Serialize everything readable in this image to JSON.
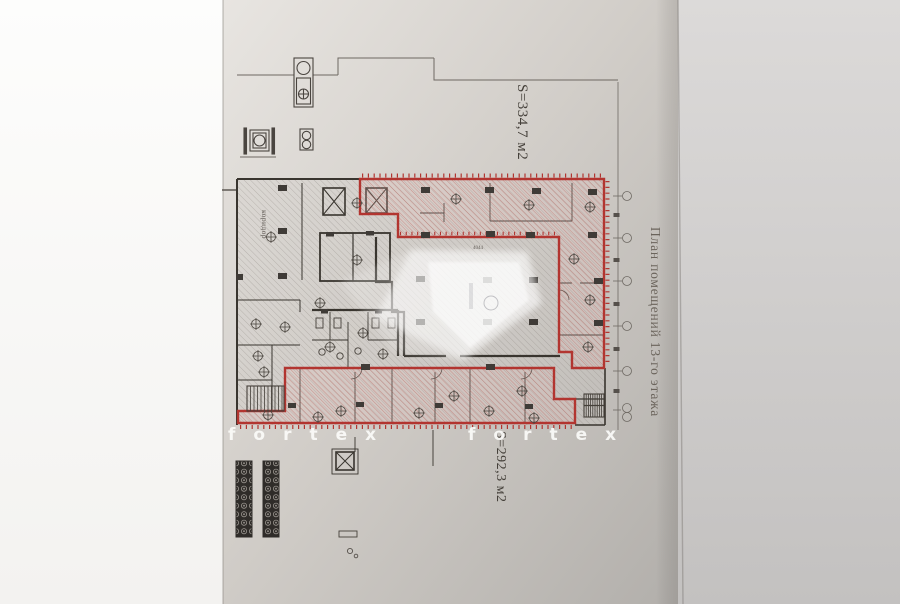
{
  "plan": {
    "title": "План помещений 13-го этажа",
    "area_top": "S=334,7 м2",
    "area_bottom": "S=292,3 м2",
    "left_room_label": "коридор",
    "dim_top": "4044"
  },
  "watermark": {
    "text": "fortex"
  },
  "colors": {
    "zone_red": "#b23530",
    "paper": "#cdc9c5",
    "ink": "#3f3b37",
    "hatch_gray": "#8a847e"
  },
  "axis": {
    "marker_count": 5
  }
}
